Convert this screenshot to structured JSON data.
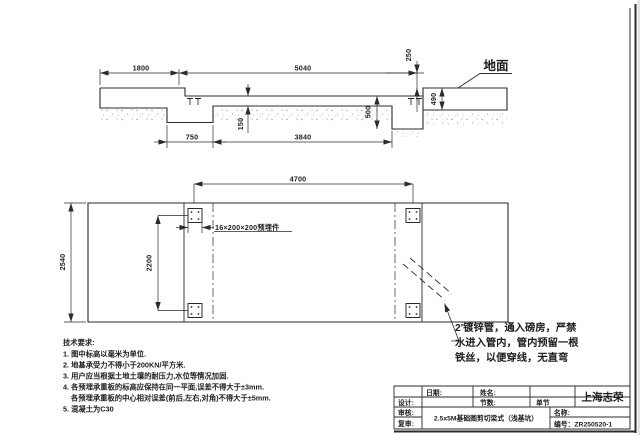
{
  "section": {
    "dim_1800": "1800",
    "dim_5040": "5040",
    "dim_250": "250",
    "dim_490": "490",
    "dim_500": "500",
    "dim_150": "150",
    "dim_750": "750",
    "dim_3840": "3840",
    "ground_label": "地面"
  },
  "plan": {
    "dim_4700": "4700",
    "dim_2540": "2540",
    "dim_2200": "2200",
    "embed_plate_label": "16×200×200预埋件",
    "conduit_note_line1": "2'镀锌管，通入磅房，严禁",
    "conduit_note_line2": "水进入管内，管内预留一根",
    "conduit_note_line3": "铁丝，以便穿线，无直弯"
  },
  "tech_notes": {
    "title": "技术要求:",
    "line1": "1. 图中标高以毫米为单位.",
    "line2": "2. 地基承受力不得小于200KN/平方米.",
    "line3": "3. 用户应当根据土地土壤的耐压力,水位等情况加固.",
    "line4": "4. 各预埋承重板的标高应保持在同一平面,误差不得大于±3mm.",
    "line5": "各预埋承重板的中心相对误差(前后,左右,对角)不得大于±5mm.",
    "line6": "5. 混凝土为C30"
  },
  "title_block": {
    "date_label": "日期:",
    "name_label": "姓名:",
    "design_label": "设计:",
    "check_label": "审核:",
    "review_label": "复审:",
    "sections_label": "节数:",
    "sections_value": "单节",
    "drawing_title": "2.5x5M基础图剪切梁式（浅基坑）",
    "product_name_label": "名称:",
    "number_label": "编号：ZR250520-1",
    "company": "上海志荣"
  }
}
